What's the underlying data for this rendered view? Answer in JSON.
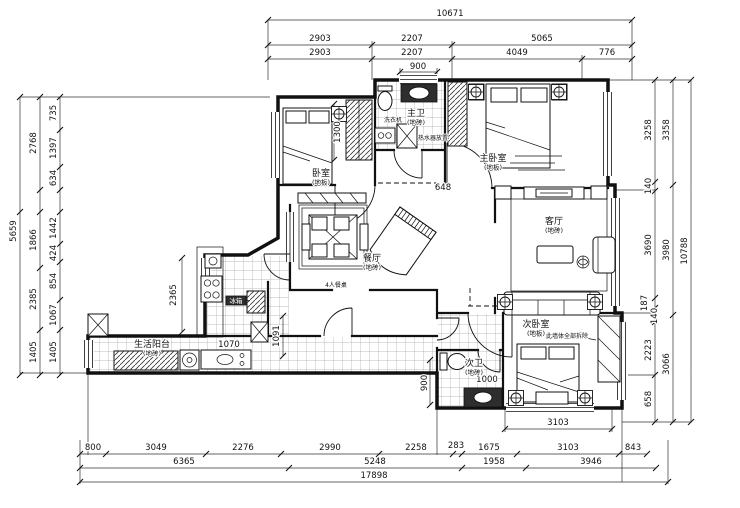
{
  "colors": {
    "line": "#111111",
    "tile_grid": "#a8a8a8",
    "background": "#ffffff",
    "fixture_dark": "#2e2e2e"
  },
  "rooms": [
    {
      "id": "bedroom-2",
      "name": "卧室",
      "floor": "(地板)",
      "x": 321,
      "y": 176
    },
    {
      "id": "master-bath",
      "name": "主卫",
      "floor": "(地砖)",
      "x": 416,
      "y": 116
    },
    {
      "id": "master-bedroom",
      "name": "主卧室",
      "floor": "(地板)",
      "x": 493,
      "y": 161
    },
    {
      "id": "dining-room",
      "name": "餐厅",
      "floor": "(地砖)",
      "x": 372,
      "y": 261
    },
    {
      "id": "living-room",
      "name": "客厅",
      "floor": "(地砖)",
      "x": 554,
      "y": 224
    },
    {
      "id": "second-bath",
      "name": "次卫",
      "floor": "(地砖)",
      "x": 474,
      "y": 366
    },
    {
      "id": "second-bedroom",
      "name": "次卧室",
      "floor": "(地板)",
      "x": 536,
      "y": 327
    },
    {
      "id": "service-balcony",
      "name": "生活阳台",
      "floor": "(地砖)",
      "x": 152,
      "y": 347
    }
  ],
  "annotations": [
    {
      "t": "洗衣机",
      "x": 393,
      "y": 122
    },
    {
      "t": "热水器放置",
      "x": 433,
      "y": 140
    },
    {
      "t": "冰箱",
      "x": 236,
      "y": 303,
      "cls": "ann inv"
    },
    {
      "t": "4人餐桌",
      "x": 336,
      "y": 287
    },
    {
      "t": "此墙体全部拆除",
      "x": 567,
      "y": 338
    }
  ],
  "dimensions": {
    "top": [
      {
        "t": "10671",
        "x": 450,
        "y": 16
      },
      {
        "t": "2903",
        "x": 320,
        "y": 41
      },
      {
        "t": "2207",
        "x": 412,
        "y": 41
      },
      {
        "t": "5065",
        "x": 542,
        "y": 41
      },
      {
        "t": "2903",
        "x": 320,
        "y": 55
      },
      {
        "t": "2207",
        "x": 412,
        "y": 55
      },
      {
        "t": "4049",
        "x": 517,
        "y": 55
      },
      {
        "t": "776",
        "x": 607,
        "y": 55
      },
      {
        "t": "900",
        "x": 418,
        "y": 69
      }
    ],
    "left": [
      {
        "t": "5659",
        "x": 16,
        "y": 231,
        "r": -90
      },
      {
        "t": "2768",
        "x": 36,
        "y": 143,
        "r": -90
      },
      {
        "t": "1866",
        "x": 36,
        "y": 240,
        "r": -90
      },
      {
        "t": "2385",
        "x": 36,
        "y": 299,
        "r": -90
      },
      {
        "t": "1405",
        "x": 36,
        "y": 352,
        "r": -90
      },
      {
        "t": "735",
        "x": 56,
        "y": 113,
        "r": -90
      },
      {
        "t": "1397",
        "x": 56,
        "y": 148,
        "r": -90
      },
      {
        "t": "634",
        "x": 56,
        "y": 178,
        "r": -90
      },
      {
        "t": "1442",
        "x": 56,
        "y": 228,
        "r": -90
      },
      {
        "t": "424",
        "x": 56,
        "y": 253,
        "r": -90
      },
      {
        "t": "854",
        "x": 56,
        "y": 281,
        "r": -90
      },
      {
        "t": "1067",
        "x": 56,
        "y": 315,
        "r": -90
      },
      {
        "t": "1405",
        "x": 56,
        "y": 352,
        "r": -90
      }
    ],
    "right": [
      {
        "t": "3258",
        "x": 651,
        "y": 130,
        "r": -90
      },
      {
        "t": "140",
        "x": 651,
        "y": 186,
        "r": -90
      },
      {
        "t": "3690",
        "x": 651,
        "y": 245,
        "r": -90
      },
      {
        "t": "187",
        "x": 647,
        "y": 303,
        "r": -90
      },
      {
        "t": "140",
        "x": 657,
        "y": 316,
        "r": -90
      },
      {
        "t": "2223",
        "x": 651,
        "y": 350,
        "r": -90
      },
      {
        "t": "658",
        "x": 651,
        "y": 399,
        "r": -90
      },
      {
        "t": "3358",
        "x": 669,
        "y": 130,
        "r": -90
      },
      {
        "t": "3980",
        "x": 669,
        "y": 250,
        "r": -90
      },
      {
        "t": "3066",
        "x": 669,
        "y": 364,
        "r": -90
      },
      {
        "t": "10788",
        "x": 687,
        "y": 251,
        "r": -90
      }
    ],
    "bottom": [
      {
        "t": "800",
        "x": 93,
        "y": 450
      },
      {
        "t": "3049",
        "x": 156,
        "y": 450
      },
      {
        "t": "2276",
        "x": 243,
        "y": 450
      },
      {
        "t": "2990",
        "x": 330,
        "y": 450
      },
      {
        "t": "2258",
        "x": 416,
        "y": 450
      },
      {
        "t": "283",
        "x": 456,
        "y": 448
      },
      {
        "t": "1675",
        "x": 489,
        "y": 450
      },
      {
        "t": "3103",
        "x": 568,
        "y": 450
      },
      {
        "t": "843",
        "x": 633,
        "y": 450
      },
      {
        "t": "6365",
        "x": 184,
        "y": 464
      },
      {
        "t": "5248",
        "x": 375,
        "y": 464
      },
      {
        "t": "1958",
        "x": 494,
        "y": 464
      },
      {
        "t": "3946",
        "x": 591,
        "y": 464
      },
      {
        "t": "17898",
        "x": 374,
        "y": 478
      }
    ],
    "interior": [
      {
        "t": "3103",
        "x": 558,
        "y": 425
      },
      {
        "t": "1300",
        "x": 340,
        "y": 132,
        "r": -90
      },
      {
        "t": "2365",
        "x": 176,
        "y": 295,
        "r": -90
      },
      {
        "t": "1070",
        "x": 229,
        "y": 347
      },
      {
        "t": "1000",
        "x": 487,
        "y": 382
      },
      {
        "t": "900",
        "x": 427,
        "y": 383,
        "r": -90
      },
      {
        "t": "648",
        "x": 443,
        "y": 190
      },
      {
        "t": "1091",
        "x": 279,
        "y": 336,
        "r": -90
      }
    ]
  }
}
